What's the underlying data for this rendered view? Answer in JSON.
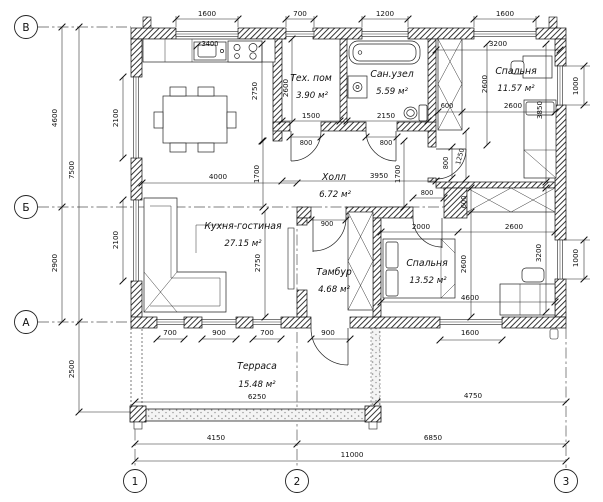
{
  "drawing": {
    "axes": {
      "rows": [
        "В",
        "Б",
        "А"
      ],
      "cols": [
        "1",
        "2",
        "3"
      ]
    },
    "rooms": {
      "kitchen": {
        "name": "Кухня-гостиная",
        "area": "27.15 м²"
      },
      "tech": {
        "name": "Тех. пом",
        "area": "3.90 м²"
      },
      "bath": {
        "name": "Сан.узел",
        "area": "5.59 м²"
      },
      "bedroom1": {
        "name": "Спальня",
        "area": "11.57 м²"
      },
      "hall": {
        "name": "Холл",
        "area": "6.72 м²"
      },
      "tambour": {
        "name": "Тамбур",
        "area": "4.68 м²"
      },
      "bedroom2": {
        "name": "Спальня",
        "area": "13.52 м²"
      },
      "terrace": {
        "name": "Терраса",
        "area": "15.48 м²"
      }
    },
    "dims": {
      "top": [
        "1600",
        "700",
        "1200",
        "1600"
      ],
      "left": {
        "win1": "2100",
        "win2": "2100",
        "seg1": "4600",
        "seg2": "2900",
        "total": "7500",
        "terrace": "2500"
      },
      "right": {
        "win1": "1000",
        "win2": "1000"
      },
      "bottom": {
        "win1": "700",
        "win2": "900",
        "win3": "700",
        "door": "900",
        "win4": "1600",
        "terrace": "6250",
        "right": "4750",
        "span12": "4150",
        "span23": "6850",
        "total": "11000"
      },
      "interior": {
        "counter": "3400",
        "tech_w": "1500",
        "tech_h": "2600",
        "kitchen_top": "2750",
        "kitchen_w": "4000",
        "kitchen_h": "2750",
        "bath_w": "2150",
        "b1_top": "3200",
        "b1_ward": "600",
        "b1_w": "2600",
        "b1_h": "2600",
        "b1_d": "3850",
        "b1_door": "800",
        "b1_off": "1250",
        "hall_l": "1700",
        "hall_r": "1700",
        "hall_w": "3950",
        "tech_door": "800",
        "bath_door": "800",
        "tam_door": "900",
        "b2_door": "800",
        "b2_ward": "600",
        "b2_seg1": "2000",
        "b2_seg2": "2600",
        "b2_h": "2600",
        "b2_right": "3200",
        "b2_w": "4600"
      }
    }
  }
}
